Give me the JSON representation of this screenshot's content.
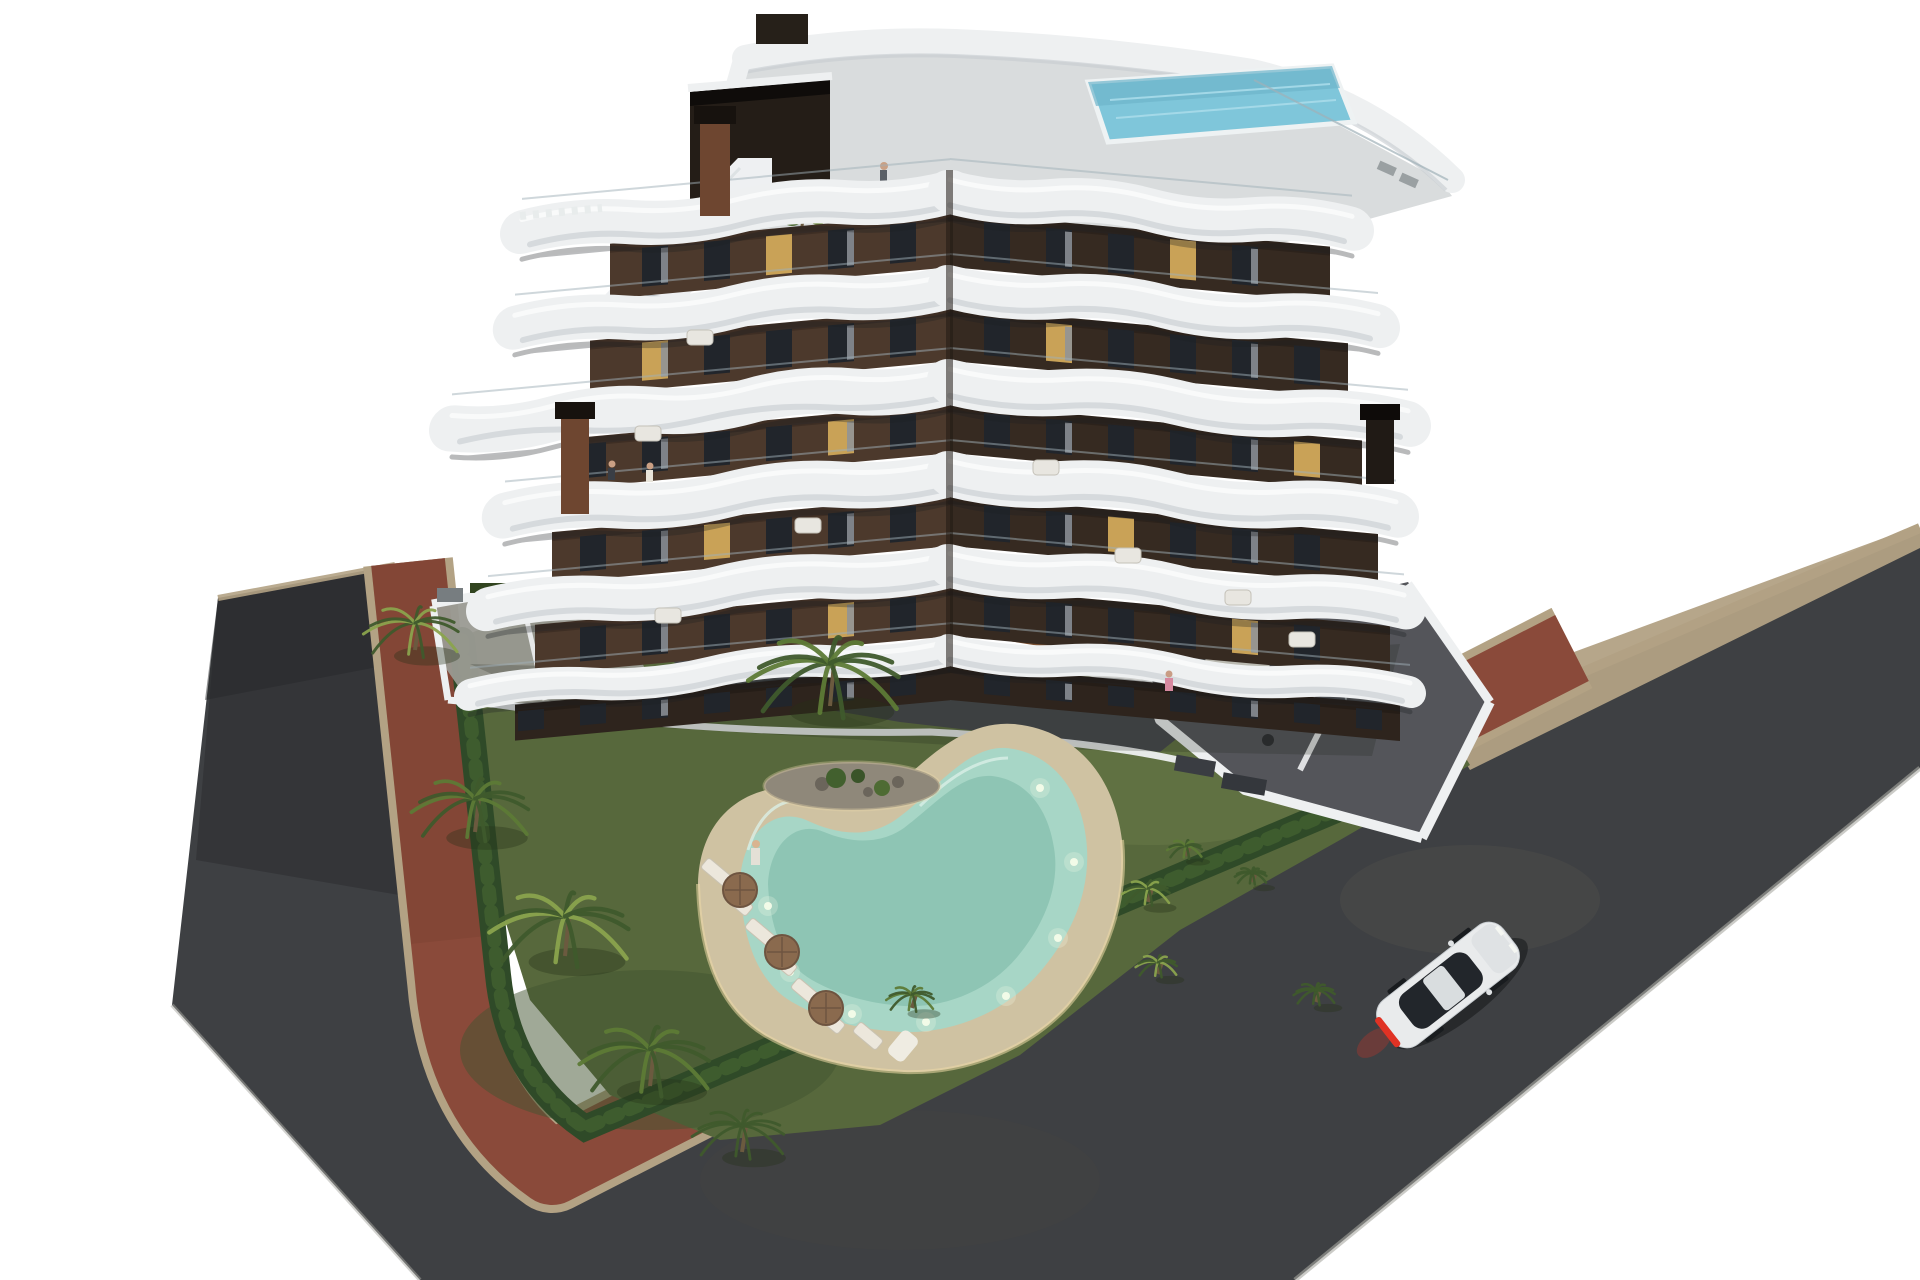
{
  "scene": {
    "type": "3d-architectural-rendering",
    "description": "Aerial dusk rendering of a modern seven-storey apartment building with dark brown facades and white curved wrap-around balconies, a rooftop terrace with plunge pool and exterior stair, a landscaped garden with palm trees, a glowing kidney-shaped swimming pool with sun loungers and brown parasols, white perimeter walls with furnished ground-floor terraces, a red brick sidewalk and dark asphalt road wrapping the plot, and a white sports car with red taillights driving on the road.",
    "objects": [
      "white background",
      "dark asphalt road",
      "red brick sidewalk band",
      "tan curb strips",
      "boxwood hedge",
      "garden lawn",
      "planted rock island",
      "kidney-shaped swimming pool with underwater lights",
      "sand-colored pool deck",
      "sun loungers",
      "brown parasols",
      "palm trees",
      "apartment building with white wavy balcony bands",
      "rooftop terrace with plunge pool and staircase",
      "rust chimney stacks",
      "white perimeter walls and furnished terraces",
      "white sports car with red taillights",
      "tiny resident figures"
    ]
  },
  "colors": {
    "background": "#ffffff",
    "asphalt": "#3e4043",
    "asphalt_dark": "#2b2c2f",
    "sidewalk_red": "#8a4a3a",
    "curb_tan": "#b3a284",
    "hedge": "#2f4a28",
    "hedge_light": "#4a6b33",
    "lawn": "#57683c",
    "lawn_light": "#6a7a48",
    "lawn_dark": "#42532f",
    "deck_sand": "#cfc2a2",
    "deck_glow": "#ecd9a6",
    "pool_water": "#a7d6c6",
    "pool_deep": "#86bfae",
    "pool_light": "#f4fce9",
    "island_rock": "#8f887a",
    "concrete": "#9a9a92",
    "terrace_floor": "#54555a",
    "courtyard_floor": "#46484c",
    "facade_left": "#4c392c",
    "facade_right": "#362a21",
    "facade_dark": "#2e241d",
    "band_white": "#eef0f1",
    "band_highlight": "#fafbfc",
    "band_shadow": "#c6ccd0",
    "glass_rail": "#9fb0b8",
    "window_dark": "#21252b",
    "window_lit": "#c9a257",
    "rooftop_deck": "#d9dcdd",
    "roof_pool": "#7fc6da",
    "chimney_rust": "#6e4630",
    "chimney_cap": "#17120e",
    "palm_trunk": "#6b5a3f",
    "palm_light": "#8aa34d",
    "palm_mid": "#5d7a36",
    "palm_dark": "#3f5a2c",
    "umbrella": "#8a6a4e",
    "lounger": "#ece7dc",
    "car_body": "#e9ebec",
    "car_glass": "#22262b",
    "taillight": "#e03224"
  },
  "building": {
    "seam_x": 950,
    "floor_band_y": [
      192,
      287,
      382,
      474,
      566,
      650
    ],
    "band_height": [
      44,
      44,
      46,
      46,
      44,
      32
    ],
    "left_wing": {
      "transform": "translate(0,88.35) skewY(-5.3)",
      "band_end_x": [
        522,
        515,
        452,
        505,
        488,
        470
      ],
      "facade_end_x": [
        610,
        590,
        570,
        552,
        535,
        515
      ]
    },
    "right_wing": {
      "transform": "translate(0,-86.4) skewY(5.2)",
      "band_end_x": [
        1352,
        1378,
        1408,
        1396,
        1404,
        1410
      ],
      "facade_end_x": [
        1330,
        1348,
        1362,
        1378,
        1390,
        1400
      ]
    },
    "window_spacing": 62,
    "window_width": 26,
    "lit_windows": [
      [
        0,
        "L",
        2
      ],
      [
        0,
        "R",
        3
      ],
      [
        1,
        "R",
        1
      ],
      [
        1,
        "L",
        4
      ],
      [
        2,
        "L",
        1
      ],
      [
        2,
        "R",
        5
      ],
      [
        3,
        "R",
        2
      ],
      [
        3,
        "L",
        3
      ],
      [
        4,
        "R",
        4
      ],
      [
        4,
        "L",
        1
      ]
    ]
  },
  "garden": {
    "palms": [
      {
        "x": 830,
        "y": 706,
        "r": 95,
        "tone": "mid"
      },
      {
        "x": 415,
        "y": 650,
        "r": 60,
        "tone": "light"
      },
      {
        "x": 475,
        "y": 832,
        "r": 74,
        "tone": "mid"
      },
      {
        "x": 565,
        "y": 956,
        "r": 88,
        "tone": "light"
      },
      {
        "x": 650,
        "y": 1086,
        "r": 82,
        "tone": "mid"
      },
      {
        "x": 742,
        "y": 1152,
        "r": 58,
        "tone": "dark"
      },
      {
        "x": 1148,
        "y": 902,
        "r": 30,
        "tone": "light"
      },
      {
        "x": 1186,
        "y": 856,
        "r": 22,
        "tone": "mid"
      },
      {
        "x": 1158,
        "y": 974,
        "r": 26,
        "tone": "light"
      },
      {
        "x": 1252,
        "y": 882,
        "r": 20,
        "tone": "dark"
      },
      {
        "x": 1316,
        "y": 1002,
        "r": 26,
        "tone": "dark"
      },
      {
        "x": 912,
        "y": 1008,
        "r": 30,
        "tone": "mid"
      }
    ],
    "loungers": [
      {
        "x": 716,
        "y": 872,
        "rot": -50
      },
      {
        "x": 738,
        "y": 902,
        "rot": -50
      },
      {
        "x": 760,
        "y": 932,
        "rot": -50
      },
      {
        "x": 782,
        "y": 962,
        "rot": -50
      },
      {
        "x": 806,
        "y": 992,
        "rot": -50
      },
      {
        "x": 830,
        "y": 1020,
        "rot": -50
      },
      {
        "x": 868,
        "y": 1036,
        "rot": -50
      }
    ],
    "umbrellas": [
      [
        740,
        890
      ],
      [
        782,
        952
      ],
      [
        826,
        1008
      ]
    ],
    "pool_lights": [
      [
        768,
        906
      ],
      [
        790,
        972
      ],
      [
        852,
        1014
      ],
      [
        926,
        1022
      ],
      [
        1006,
        996
      ],
      [
        1058,
        938
      ],
      [
        1074,
        862
      ],
      [
        1040,
        788
      ]
    ]
  },
  "balcony_sofas": [
    [
      700,
      338
    ],
    [
      648,
      434
    ],
    [
      808,
      526
    ],
    [
      1046,
      468
    ],
    [
      1128,
      556
    ],
    [
      1238,
      598
    ],
    [
      668,
      616
    ],
    [
      1302,
      640
    ]
  ]
}
